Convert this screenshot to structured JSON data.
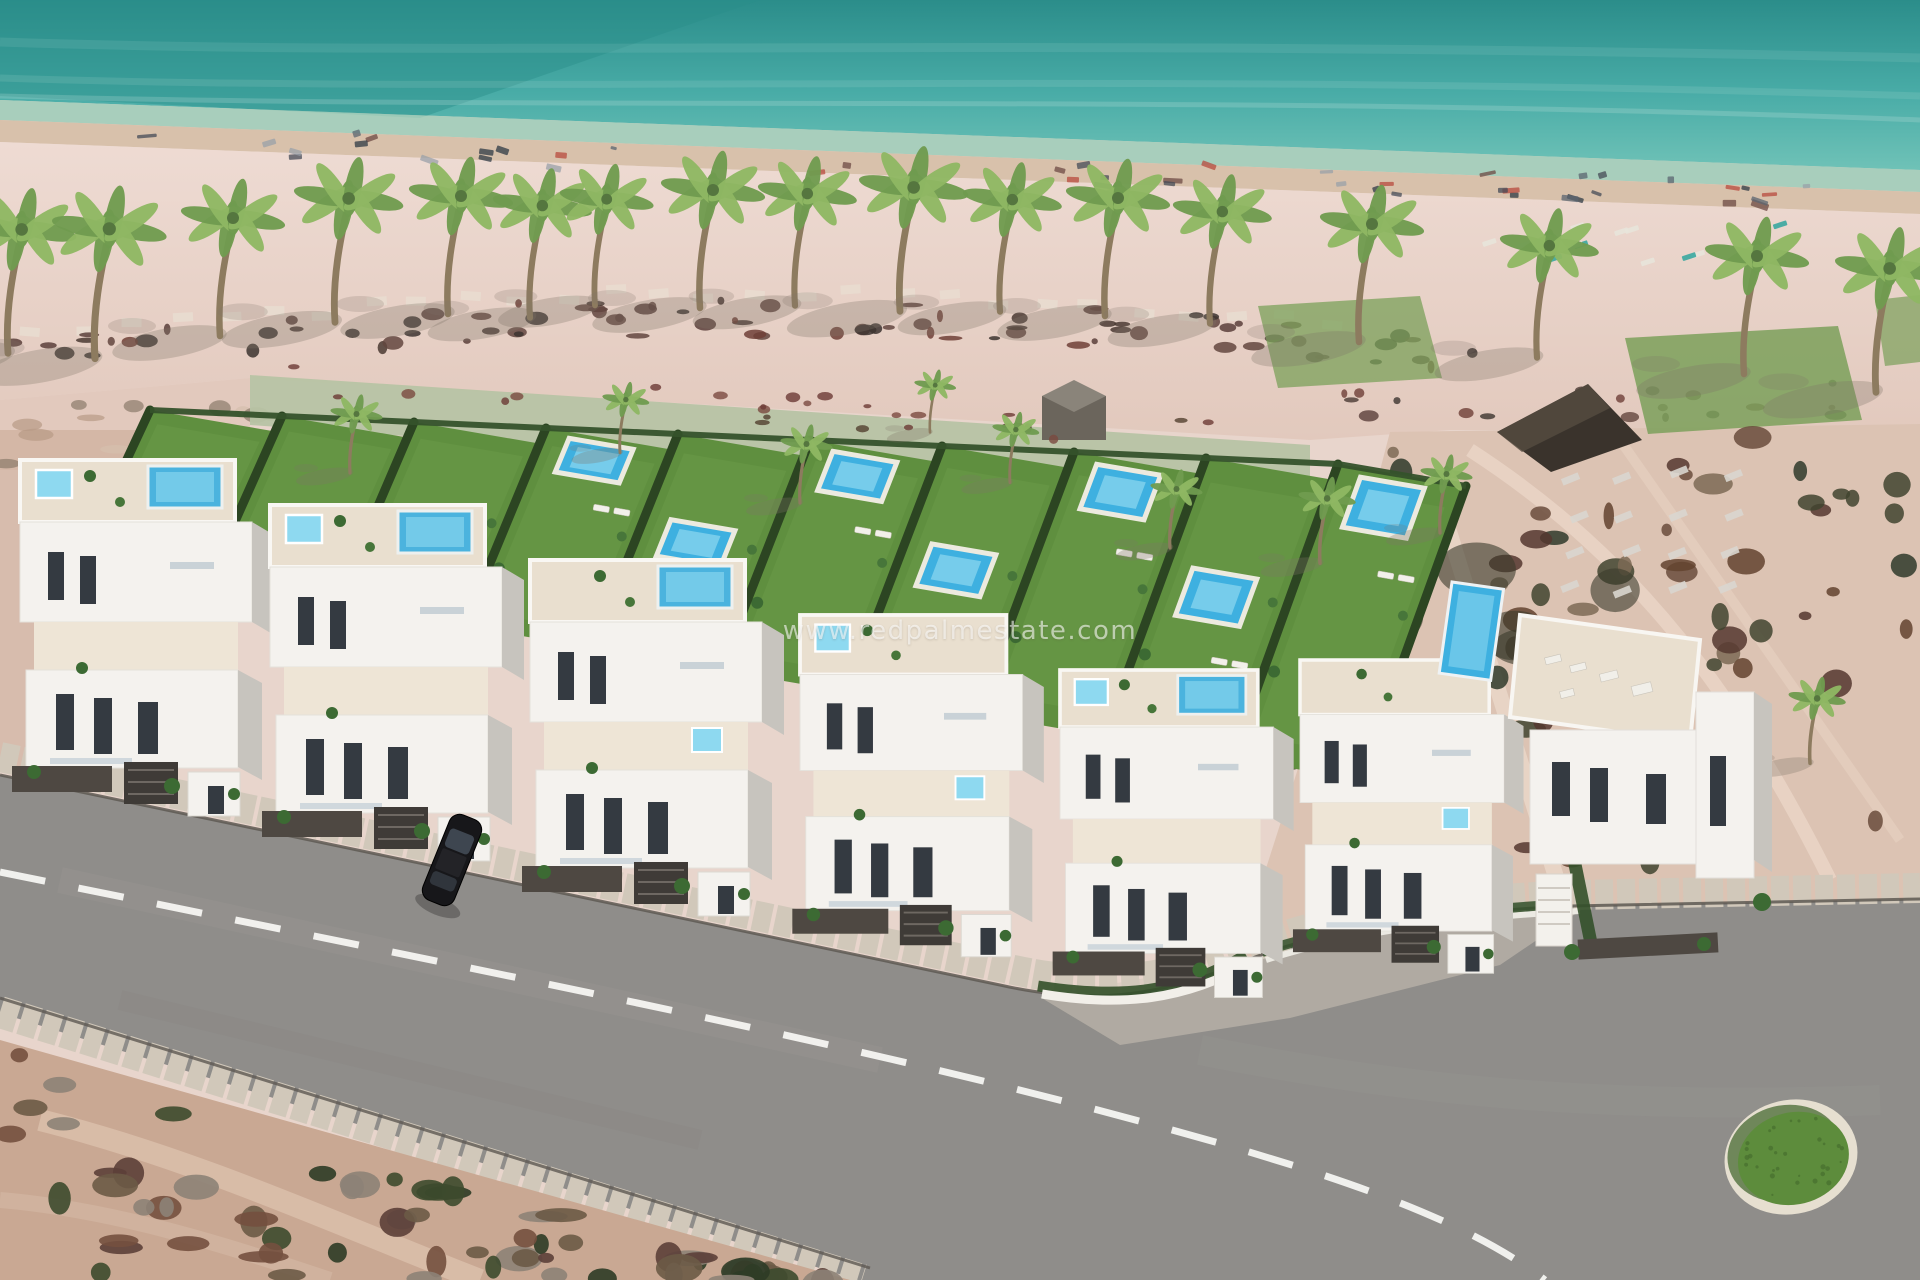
{
  "watermark": {
    "text": "www.redpalmestate.com"
  },
  "scene": {
    "label": "Aerial 3D render of a beachfront white townhouse development with private pools, palm-lined sandy beach, turquoise sea and curving coastal road with roundabout",
    "colors": {
      "sea_deep": "#2b8d8a",
      "sea_mid": "#49aca7",
      "sea_shallow": "#6fc2b7",
      "sandbar": "#9ccdb9",
      "wet_sand": "#d8c1ab",
      "sand": "#eedbd3",
      "sand_dark": "#e2c9bd",
      "promenade": "#b7c3a4",
      "lawn": "#5f8f3f",
      "lawn_light": "#73a04c",
      "hedge": "#2c4522",
      "hedge_dark": "#33502a",
      "pool": "#3eb0e0",
      "pool_light": "#8ed9f0",
      "deck": "#eceadf",
      "building": "#f4f2ee",
      "building_shade": "#c7c4be",
      "terrace": "#e9dfcf",
      "terrace2": "#eee5d6",
      "window": "#343a41",
      "fence": "#4e4842",
      "garage": "#3f3b37",
      "road": "#8f8d8a",
      "sidewalk": "#d1c8ba",
      "curb": "#5e5952",
      "dash": "#f5f5f2",
      "scrub_left": "#c9a893",
      "scrub_right": "#dcc3b3",
      "green_patch": "#7ba05a",
      "rb_green": "#5d8c3c",
      "rb_ring": "#e6dfd0",
      "palm_trunk": "#8d7b5f",
      "palm_dark": "#6f9b4f",
      "palm_light": "#8fb763",
      "shadow": "#7e7468",
      "hut": "#3a332c",
      "wall_white": "#f2efe9"
    },
    "palms": [
      [
        8,
        347,
        1.05
      ],
      [
        95,
        352,
        1.1
      ],
      [
        220,
        330,
        1.0
      ],
      [
        335,
        316,
        1.05
      ],
      [
        448,
        308,
        1.0
      ],
      [
        530,
        312,
        0.95
      ],
      [
        595,
        300,
        0.9
      ],
      [
        700,
        302,
        1.0
      ],
      [
        795,
        300,
        0.95
      ],
      [
        900,
        305,
        1.05
      ],
      [
        1000,
        306,
        0.95
      ],
      [
        1105,
        310,
        1.0
      ],
      [
        1210,
        318,
        0.95
      ],
      [
        1359,
        336,
        1.0
      ],
      [
        1537,
        352,
        0.95
      ],
      [
        1744,
        368,
        1.0
      ],
      [
        1876,
        386,
        1.05
      ]
    ],
    "garden_palms": [
      [
        350,
        470,
        0.5
      ],
      [
        620,
        450,
        0.45
      ],
      [
        800,
        500,
        0.5
      ],
      [
        1010,
        480,
        0.45
      ],
      [
        1170,
        545,
        0.5
      ],
      [
        930,
        430,
        0.4
      ],
      [
        1320,
        560,
        0.55
      ],
      [
        1440,
        530,
        0.5
      ],
      [
        1810,
        760,
        0.55
      ]
    ],
    "gardens": {
      "origin": [
        80,
        560
      ],
      "step": [
        128,
        22
      ],
      "count": 10,
      "depth_base": [
        70,
        -150
      ],
      "depth_grow": [
        4,
        -16
      ],
      "upper_pool_plots": [
        3,
        5,
        7,
        9
      ],
      "lower_pool_plots": [
        4,
        6,
        8
      ]
    },
    "buildings": [
      {
        "x": 20,
        "y": 460,
        "s": 1.0,
        "roofpool": true,
        "jacuzzi": true,
        "jacuzzi2": false
      },
      {
        "x": 270,
        "y": 505,
        "s": 1.0,
        "roofpool": true,
        "jacuzzi": true,
        "jacuzzi2": false
      },
      {
        "x": 530,
        "y": 560,
        "s": 1.0,
        "roofpool": true,
        "jacuzzi": false,
        "jacuzzi2": true
      },
      {
        "x": 800,
        "y": 615,
        "s": 0.96,
        "roofpool": false,
        "jacuzzi": true,
        "jacuzzi2": true
      },
      {
        "x": 1060,
        "y": 670,
        "s": 0.92,
        "roofpool": true,
        "jacuzzi": true,
        "jacuzzi2": false
      },
      {
        "x": 1300,
        "y": 660,
        "s": 0.88,
        "roofpool": false,
        "jacuzzi": false,
        "jacuzzi2": true
      }
    ],
    "car": {
      "x": 452,
      "y": 860,
      "angle": 22
    },
    "roundabout": {
      "cx": 1791,
      "cy": 1157,
      "rx": 58,
      "ry": 48,
      "angle": -14
    }
  }
}
